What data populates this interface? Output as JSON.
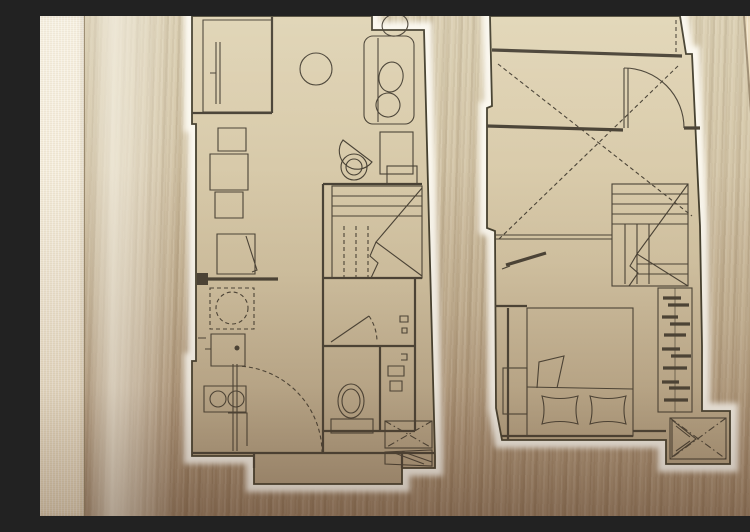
{
  "scene": {
    "alt": "Photograph of a brushed champagne-gold metal panel engraved with two laser-cut apartment floor plans of a loft unit, mounted on a cream fabric-textured wall",
    "colors": {
      "wallpaper": "#f3ead6",
      "plate_top": "#d9cdae",
      "plate_bottom": "#977c60",
      "bevel_highlight": "#f0eada",
      "island_top": "#e0d4b5",
      "island_bottom": "#b5a284",
      "cut_margin": "#f9f6ec",
      "line": "#4a4336",
      "wall_line": "#3b362c",
      "right_wall": "#e7d4b2",
      "plate_edge": "#8a795e"
    },
    "plans": [
      {
        "label": "Lower level floor plan",
        "name": "lower-level-plan",
        "rooms": [
          "balcony",
          "living-dining",
          "kitchen",
          "bathroom",
          "entry",
          "staircase"
        ],
        "furniture": [
          "sliding-door",
          "round-table",
          "sofa",
          "sofa-cushions",
          "lounge-chair",
          "side-table",
          "tv-cabinet",
          "cabinet-stack",
          "fridge-open-door",
          "kitchen-counter",
          "washing-machine",
          "kitchen-sink",
          "two-burner-cooktop",
          "stair-treads",
          "ceiling-fixture",
          "bathroom-door",
          "shower-fitting",
          "toilet",
          "storage-niche",
          "entry-door-swing",
          "air-conditioner",
          "ac-louver"
        ]
      },
      {
        "label": "Upper level floor plan",
        "name": "upper-level-plan",
        "rooms": [
          "landing",
          "void-over-living",
          "bedroom",
          "staircase"
        ],
        "furniture": [
          "entry-door-swing",
          "wall-insulation-ticks",
          "void-cross-lines",
          "void-floor-edge",
          "section-marker-bar",
          "stair-treads",
          "wardrobe-with-hangers",
          "double-bed",
          "pillows",
          "folded-blanket",
          "bedside-unit",
          "air-conditioner"
        ]
      }
    ]
  }
}
